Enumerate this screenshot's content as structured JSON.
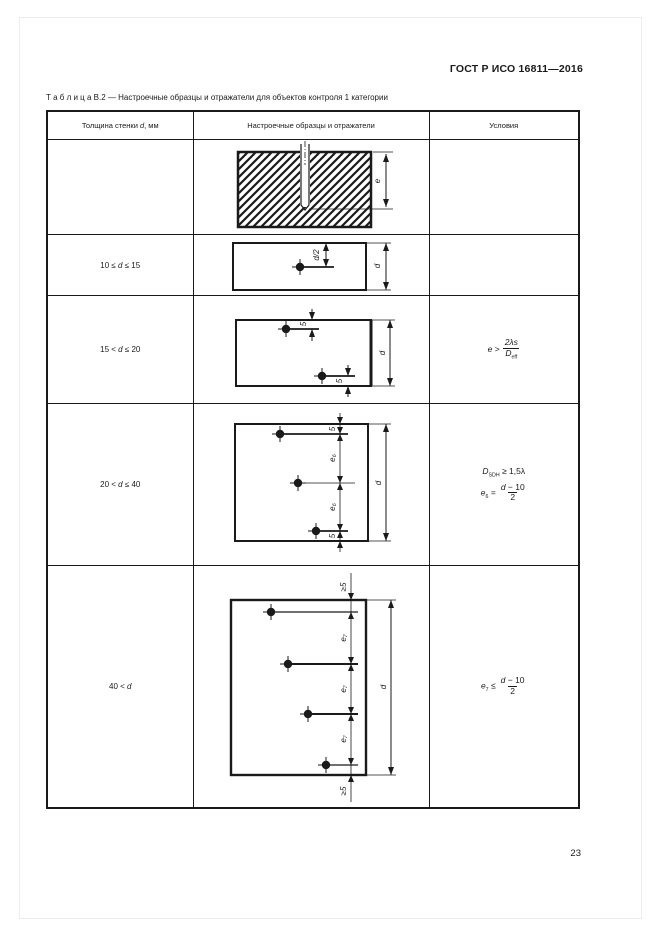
{
  "page": {
    "header": "ГОСТ Р ИСО 16811—2016",
    "page_number": "23"
  },
  "caption": {
    "label": "Т а б л и ц а  В.2",
    "text": "— Настроечные образцы и отражатели для объектов контроля 1 категории"
  },
  "table": {
    "headers": {
      "thickness_pre": "Толщина стенки ",
      "thickness_var": "d",
      "thickness_post": ", мм",
      "samples": "Настроечные образцы и отражатели",
      "conditions": "Условия"
    }
  },
  "rows": {
    "r1": {
      "thickness": "",
      "labels": {
        "e": "e"
      }
    },
    "r2": {
      "thickness_pre": "10 ≤ ",
      "thickness_var": "d",
      "thickness_post": " ≤ 15",
      "labels": {
        "half": "d/2",
        "d": "d"
      }
    },
    "r3": {
      "thickness_pre": "15 < ",
      "thickness_var": "d",
      "thickness_post": " ≤ 20",
      "labels": {
        "top_offset": "5",
        "bottom_offset": "5",
        "d": "d"
      },
      "condition": {
        "lhs": "e",
        "op": ">",
        "num": "2λs",
        "den_base": "D",
        "den_sub": "eff"
      }
    },
    "r4": {
      "thickness_pre": "20 < ",
      "thickness_var": "d",
      "thickness_post": " ≤ 40",
      "labels": {
        "edge_top": "5",
        "gap1": "e₆",
        "gap2": "e₆",
        "edge_bottom": "5",
        "d": "d"
      },
      "condition": {
        "line1_base": "D",
        "line1_sub": "SDH",
        "line1_rest": " ≥ 1,5λ",
        "lhs_base": "e",
        "lhs_sub": "6",
        "op": "=",
        "num_var": "d",
        "num_rest": " − 10",
        "den": "2"
      }
    },
    "r5": {
      "thickness_pre": "40 < ",
      "thickness_var": "d",
      "thickness_post": "",
      "labels": {
        "edge_top": "≥5",
        "gap1": "e₇",
        "gap2": "e₇",
        "gap3": "e₇",
        "edge_bottom": "≥5",
        "d": "d"
      },
      "condition": {
        "lhs_base": "e",
        "lhs_sub": "7",
        "op": "≤",
        "num_var": "d",
        "num_rest": " − 10",
        "den": "2"
      }
    }
  }
}
